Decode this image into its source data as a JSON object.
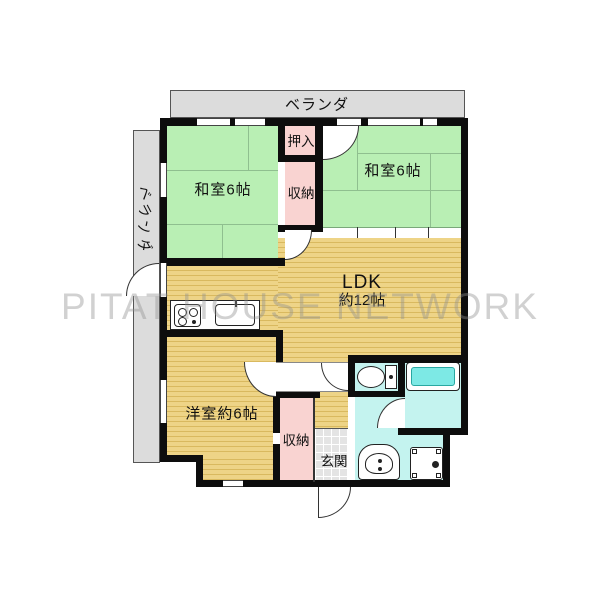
{
  "plan_title": "2LDK apartment floor plan",
  "watermark": "PITAT HOUSE NETWORK",
  "balconies": {
    "top": "ベランダ",
    "left": "ベランダ"
  },
  "rooms": {
    "washitsu_left": {
      "label": "和室6帖"
    },
    "washitsu_right": {
      "label": "和室6帖"
    },
    "oshiire": {
      "label": "押入"
    },
    "closet_upper": {
      "label": "収納"
    },
    "ldk": {
      "label": "LDK",
      "size": "約12帖"
    },
    "youshitsu": {
      "label": "洋室約6帖"
    },
    "closet_lower": {
      "label": "収納"
    },
    "genkan": {
      "label": "玄関"
    }
  },
  "fixtures": [
    {
      "icon": "gas-stove-icon"
    },
    {
      "icon": "kitchen-sink-icon"
    },
    {
      "icon": "toilet-icon"
    },
    {
      "icon": "bathtub-icon"
    },
    {
      "icon": "washbasin-icon"
    },
    {
      "icon": "washing-machine-icon"
    }
  ],
  "colors": {
    "tatami_green": "#b9efb4",
    "wood_floor": "#eccf7d",
    "closet_pink": "#f9d3d1",
    "wet_area_cyan": "#c4f3ef",
    "bathtub_cyan": "#7de9e5",
    "balcony_gray": "#dcdcdc",
    "wall_black": "#0d0d0d"
  }
}
